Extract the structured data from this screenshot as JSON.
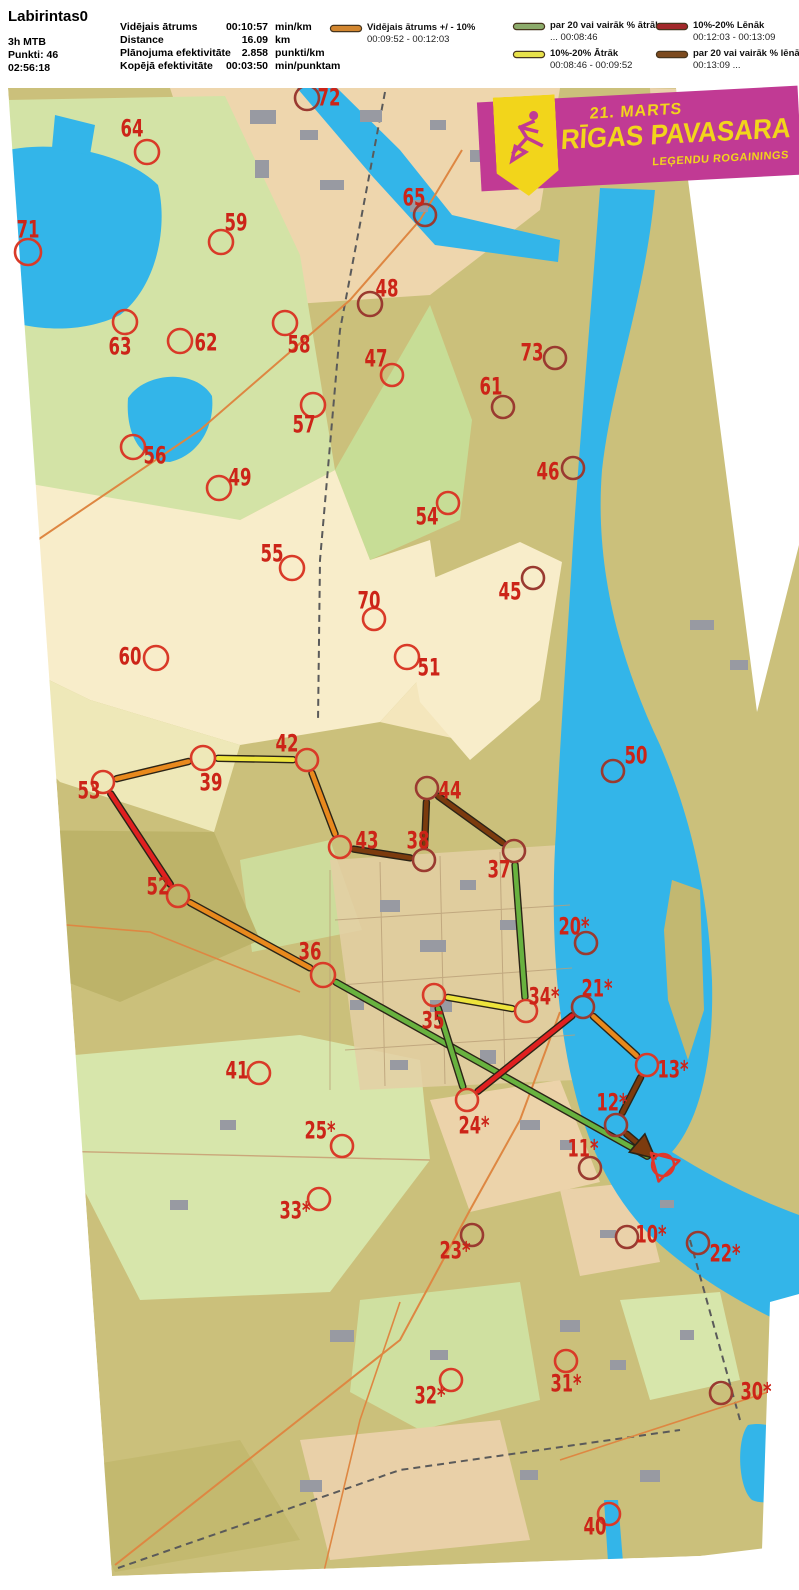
{
  "header": {
    "title": "Labirintas0",
    "class_label": "3h MTB",
    "points": "Punkti: 46",
    "total_time": "02:56:18",
    "stats": [
      {
        "label": "Vidējais ātrums",
        "value": "00:10:57",
        "unit": "min/km"
      },
      {
        "label": "Distance",
        "value": "16.09",
        "unit": "km"
      },
      {
        "label": "Plānojuma efektivitāte",
        "value": "2.858",
        "unit": "punkti/km"
      },
      {
        "label": "Kopējā efektivitāte",
        "value": "00:03:50",
        "unit": "min/punktam"
      }
    ]
  },
  "legend": {
    "entries": [
      {
        "name": "average",
        "color": "#d2862f",
        "label": "Vidējais ātrums +/ - 10%",
        "range": "00:09:52  -  00:12:03"
      },
      {
        "name": "much-faster",
        "color": "#8cab6b",
        "label": "par 20 vai vairāk % ātrāk",
        "range": "...  00:08:46"
      },
      {
        "name": "faster",
        "color": "#e7e14b",
        "label": "10%-20% Ātrāk",
        "range": "00:08:46  -  00:09:52"
      },
      {
        "name": "slower",
        "color": "#a2282a",
        "label": "10%-20% Lēnāk",
        "range": "00:12:03  -  00:13:09"
      },
      {
        "name": "much-slower",
        "color": "#7c4a1e",
        "label": "par 20 vai vairāk % lēnāk",
        "range": "00:13:09  ..."
      }
    ]
  },
  "banner": {
    "date": "21. MARTS",
    "title": "RĪGAS PAVASARA",
    "subtitle": "LEĢENDU ROGAININGS",
    "bg": "#c13a94",
    "fg": "#f2d51b"
  },
  "map": {
    "label_color": "#cc2418",
    "circle_color": "#d93a28",
    "circle_dark_color": "#9a3a30",
    "start_color": "#e0362a",
    "route_colors": {
      "green": "#68b23f",
      "orange": "#e8891d",
      "yellow": "#ede43c",
      "red": "#e02020",
      "brown": "#7c3b0e"
    },
    "start": {
      "x": 663,
      "y": 1165
    },
    "controls": [
      {
        "id": "72",
        "n": "72",
        "x": 307,
        "y": 98,
        "r": 12,
        "lx": 329,
        "ly": 97,
        "dark": true
      },
      {
        "id": "64",
        "n": "64",
        "x": 147,
        "y": 152,
        "r": 12,
        "lx": 132,
        "ly": 128,
        "dark": false
      },
      {
        "id": "71",
        "n": "71",
        "x": 28,
        "y": 252,
        "r": 13,
        "lx": 28,
        "ly": 229,
        "dark": false
      },
      {
        "id": "65",
        "n": "65",
        "x": 425,
        "y": 215,
        "r": 11,
        "lx": 414,
        "ly": 197,
        "dark": true
      },
      {
        "id": "59",
        "n": "59",
        "x": 221,
        "y": 242,
        "r": 12,
        "lx": 236,
        "ly": 222,
        "dark": false
      },
      {
        "id": "48",
        "n": "48",
        "x": 370,
        "y": 304,
        "r": 12,
        "lx": 387,
        "ly": 288,
        "dark": true
      },
      {
        "id": "63",
        "n": "63",
        "x": 125,
        "y": 322,
        "r": 12,
        "lx": 120,
        "ly": 346,
        "dark": false
      },
      {
        "id": "62",
        "n": "62",
        "x": 180,
        "y": 341,
        "r": 12,
        "lx": 206,
        "ly": 342,
        "dark": false
      },
      {
        "id": "58",
        "n": "58",
        "x": 285,
        "y": 323,
        "r": 12,
        "lx": 299,
        "ly": 344,
        "dark": false
      },
      {
        "id": "47",
        "n": "47",
        "x": 392,
        "y": 375,
        "r": 11,
        "lx": 376,
        "ly": 358,
        "dark": false
      },
      {
        "id": "73",
        "n": "73",
        "x": 555,
        "y": 358,
        "r": 11,
        "lx": 532,
        "ly": 352,
        "dark": true
      },
      {
        "id": "57",
        "n": "57",
        "x": 313,
        "y": 405,
        "r": 12,
        "lx": 304,
        "ly": 424,
        "dark": false
      },
      {
        "id": "61",
        "n": "61",
        "x": 503,
        "y": 407,
        "r": 11,
        "lx": 491,
        "ly": 386,
        "dark": true
      },
      {
        "id": "56",
        "n": "56",
        "x": 133,
        "y": 447,
        "r": 12,
        "lx": 155,
        "ly": 455,
        "dark": false
      },
      {
        "id": "49",
        "n": "49",
        "x": 219,
        "y": 488,
        "r": 12,
        "lx": 240,
        "ly": 477,
        "dark": false
      },
      {
        "id": "46",
        "n": "46",
        "x": 573,
        "y": 468,
        "r": 11,
        "lx": 548,
        "ly": 471,
        "dark": true
      },
      {
        "id": "54",
        "n": "54",
        "x": 448,
        "y": 503,
        "r": 11,
        "lx": 427,
        "ly": 516,
        "dark": false
      },
      {
        "id": "55",
        "n": "55",
        "x": 292,
        "y": 568,
        "r": 12,
        "lx": 272,
        "ly": 553,
        "dark": false
      },
      {
        "id": "45",
        "n": "45",
        "x": 533,
        "y": 578,
        "r": 11,
        "lx": 510,
        "ly": 591,
        "dark": true
      },
      {
        "id": "70",
        "n": "70",
        "x": 374,
        "y": 619,
        "r": 11,
        "lx": 369,
        "ly": 600,
        "dark": false
      },
      {
        "id": "60",
        "n": "60",
        "x": 156,
        "y": 658,
        "r": 12,
        "lx": 130,
        "ly": 656,
        "dark": false
      },
      {
        "id": "51",
        "n": "51",
        "x": 407,
        "y": 657,
        "r": 12,
        "lx": 429,
        "ly": 667,
        "dark": false
      },
      {
        "id": "50",
        "n": "50",
        "x": 613,
        "y": 771,
        "r": 11,
        "lx": 636,
        "ly": 755,
        "dark": true
      },
      {
        "id": "42",
        "n": "42",
        "x": 307,
        "y": 760,
        "r": 11,
        "lx": 287,
        "ly": 743,
        "dark": false
      },
      {
        "id": "39",
        "n": "39",
        "x": 203,
        "y": 758,
        "r": 12,
        "lx": 211,
        "ly": 782,
        "dark": false
      },
      {
        "id": "53",
        "n": "53",
        "x": 103,
        "y": 782,
        "r": 11,
        "lx": 89,
        "ly": 790,
        "dark": false
      },
      {
        "id": "44",
        "n": "44",
        "x": 427,
        "y": 788,
        "r": 11,
        "lx": 450,
        "ly": 790,
        "dark": true
      },
      {
        "id": "43",
        "n": "43",
        "x": 340,
        "y": 847,
        "r": 11,
        "lx": 367,
        "ly": 840,
        "dark": false
      },
      {
        "id": "38",
        "n": "38",
        "x": 424,
        "y": 860,
        "r": 11,
        "lx": 418,
        "ly": 840,
        "dark": true
      },
      {
        "id": "37",
        "n": "37",
        "x": 514,
        "y": 851,
        "r": 11,
        "lx": 499,
        "ly": 869,
        "dark": true
      },
      {
        "id": "52",
        "n": "52",
        "x": 178,
        "y": 896,
        "r": 11,
        "lx": 158,
        "ly": 886,
        "dark": false
      },
      {
        "id": "20",
        "n": "20*",
        "x": 586,
        "y": 943,
        "r": 11,
        "lx": 574,
        "ly": 926,
        "dark": true
      },
      {
        "id": "36",
        "n": "36",
        "x": 323,
        "y": 975,
        "r": 12,
        "lx": 310,
        "ly": 951,
        "dark": false
      },
      {
        "id": "34",
        "n": "34*",
        "x": 526,
        "y": 1011,
        "r": 11,
        "lx": 544,
        "ly": 996,
        "dark": false
      },
      {
        "id": "21",
        "n": "21*",
        "x": 583,
        "y": 1007,
        "r": 11,
        "lx": 597,
        "ly": 988,
        "dark": true
      },
      {
        "id": "35",
        "n": "35",
        "x": 434,
        "y": 995,
        "r": 11,
        "lx": 433,
        "ly": 1020,
        "dark": false
      },
      {
        "id": "41",
        "n": "41",
        "x": 259,
        "y": 1073,
        "r": 11,
        "lx": 237,
        "ly": 1070,
        "dark": false
      },
      {
        "id": "13",
        "n": "13*",
        "x": 647,
        "y": 1065,
        "r": 11,
        "lx": 673,
        "ly": 1069,
        "dark": false
      },
      {
        "id": "12",
        "n": "12*",
        "x": 616,
        "y": 1125,
        "r": 11,
        "lx": 612,
        "ly": 1102,
        "dark": true
      },
      {
        "id": "24",
        "n": "24*",
        "x": 467,
        "y": 1100,
        "r": 11,
        "lx": 474,
        "ly": 1125,
        "dark": false
      },
      {
        "id": "25",
        "n": "25*",
        "x": 342,
        "y": 1146,
        "r": 11,
        "lx": 320,
        "ly": 1130,
        "dark": false
      },
      {
        "id": "11",
        "n": "11*",
        "x": 590,
        "y": 1168,
        "r": 11,
        "lx": 583,
        "ly": 1148,
        "dark": true
      },
      {
        "id": "33",
        "n": "33*",
        "x": 319,
        "y": 1199,
        "r": 11,
        "lx": 295,
        "ly": 1210,
        "dark": false
      },
      {
        "id": "23",
        "n": "23*",
        "x": 472,
        "y": 1235,
        "r": 11,
        "lx": 455,
        "ly": 1250,
        "dark": true
      },
      {
        "id": "10",
        "n": "10*",
        "x": 627,
        "y": 1237,
        "r": 11,
        "lx": 651,
        "ly": 1234,
        "dark": true
      },
      {
        "id": "22",
        "n": "22*",
        "x": 698,
        "y": 1243,
        "r": 11,
        "lx": 725,
        "ly": 1253,
        "dark": true
      },
      {
        "id": "32",
        "n": "32*",
        "x": 451,
        "y": 1380,
        "r": 11,
        "lx": 430,
        "ly": 1395,
        "dark": false
      },
      {
        "id": "31",
        "n": "31*",
        "x": 566,
        "y": 1361,
        "r": 11,
        "lx": 566,
        "ly": 1383,
        "dark": false
      },
      {
        "id": "30",
        "n": "30*",
        "x": 721,
        "y": 1393,
        "r": 11,
        "lx": 756,
        "ly": 1391,
        "dark": true
      },
      {
        "id": "40",
        "n": "40",
        "x": 609,
        "y": 1514,
        "r": 11,
        "lx": 595,
        "ly": 1526,
        "dark": false
      }
    ],
    "route_legs": [
      {
        "from": "start",
        "to": "36",
        "color": "green"
      },
      {
        "from": "36",
        "to": "52",
        "color": "orange"
      },
      {
        "from": "52",
        "to": "53",
        "color": "red"
      },
      {
        "from": "53",
        "to": "39",
        "color": "orange"
      },
      {
        "from": "39",
        "to": "42",
        "color": "yellow"
      },
      {
        "from": "42",
        "to": "43",
        "color": "orange"
      },
      {
        "from": "43",
        "to": "38",
        "color": "brown"
      },
      {
        "from": "38",
        "to": "44",
        "color": "brown"
      },
      {
        "from": "44",
        "to": "37",
        "color": "brown"
      },
      {
        "from": "37",
        "to": "34",
        "color": "green"
      },
      {
        "from": "34",
        "to": "35",
        "color": "yellow"
      },
      {
        "from": "35",
        "to": "24",
        "color": "green"
      },
      {
        "from": "24",
        "to": "21",
        "color": "red"
      },
      {
        "from": "21",
        "to": "13",
        "color": "orange"
      },
      {
        "from": "13",
        "to": "12",
        "color": "brown"
      },
      {
        "from": "12",
        "to": "start",
        "color": "brown",
        "arrow": true
      }
    ]
  }
}
